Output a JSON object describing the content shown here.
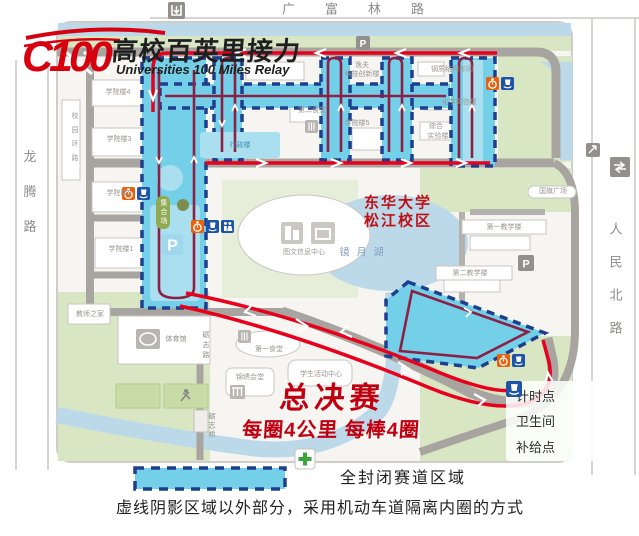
{
  "logo": {
    "mark": "C100",
    "title": "高校百英里接力",
    "subtitle": "Universities 100 Miles Relay"
  },
  "roads": {
    "top": "广富林路",
    "left": "龙腾路",
    "right": "人民北路",
    "ring": "校园环路",
    "lizhi_road": "砺志路",
    "lizhi_bridge": "砺志桥",
    "assembly_pill": "集合场"
  },
  "campus": {
    "name_line1": "东华大学",
    "name_line2": "松江校区",
    "lake": "镜月湖"
  },
  "buildings": {
    "xueyuan4": "学院楼4",
    "xueyuan3": "学院楼3",
    "xueyuan2": "学院楼2",
    "xueyuan1": "学院楼1",
    "xueyuan5": "学院楼5",
    "yifu_line1": "逸夫",
    "yifu_line2": "科技创新楼",
    "steel_workshop": "钢质结构车间",
    "chem_lab": "化学实验楼",
    "zonghe_line1": "综合",
    "zonghe_line2": "实验楼",
    "canteen2": "第二食堂",
    "canteen1": "第一食堂",
    "admin": "行政楼",
    "library": "图文信息中心",
    "flag_square": "国旗广场",
    "teach1": "第一教学楼",
    "teach2": "第二教学楼",
    "teachers_home": "教师之家",
    "gym": "体育馆",
    "jinxiu_hall": "锦绣会堂",
    "student_center": "学生活动中心"
  },
  "race": {
    "finals": "总决赛",
    "lap_info": "每圈4公里 每棒4圈"
  },
  "legend": {
    "items": [
      {
        "icon": "stopwatch-icon",
        "label": "计时点"
      },
      {
        "icon": "restroom-icon",
        "label": "卫生间"
      },
      {
        "icon": "supply-icon",
        "label": "补给点"
      }
    ],
    "closed_area_label": "全封闭赛道区域",
    "note": "虚线阴影区域以外部分，采用机动车道隔离内圈的方式"
  },
  "map": {
    "parking_label": "P"
  },
  "colors": {
    "route_red": "#e8001c",
    "route_inner_maroon": "#8c2045",
    "zone_cyan": "#74cfe8",
    "zone_border_navy": "#1e3e8e",
    "timing_orange": "#e8610d",
    "facility_blue": "#1d53a8",
    "race_text_red": "#c00010"
  }
}
